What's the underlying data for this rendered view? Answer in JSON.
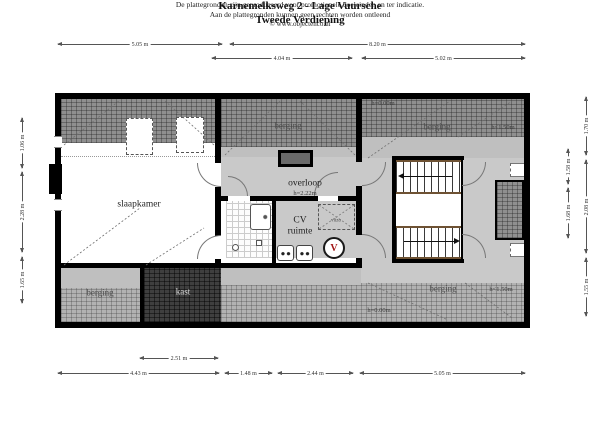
{
  "title": {
    "line1": "Karnemelksweg 2 - Lage Vuursche",
    "line2": "Tweede Verdieping"
  },
  "dims": {
    "t1a": "5.05 m",
    "t1b": "8.20 m",
    "t2a": "4.04 m",
    "t2b": "5.02 m",
    "b1a": "2.51 m",
    "b2a": "4.43 m",
    "b2b": "1.48 m",
    "b2c": "2.44 m",
    "b2d": "5.05 m",
    "l1": "1.06 m",
    "l2": "2.28 m",
    "l3": "1.65 m",
    "r1": "1.70 m",
    "r2": "2.08 m",
    "r3": "1.55 m",
    "ri1": "1.58 m",
    "ri2": "1.68 m"
  },
  "rooms": {
    "slaapkamer": "slaapkamer",
    "overloop": "overloop",
    "overloop_h": "h=2.22m",
    "cv1": "CV",
    "cv2": "ruimte",
    "vlizo": "vlizo",
    "v_unit": "V",
    "kast": "kast",
    "berging_top_mid": "berging",
    "berging_top_right": "berging",
    "berging_bottom_left": "berging",
    "berging_bottom_right": "berging"
  },
  "annotations": {
    "h0_top": "h=0.00m",
    "h150_top": "h<1.50m",
    "h150_bottom": "h<1.50m",
    "h0_bottom": "h=0.00m"
  },
  "footer": {
    "line1": "De plattegronden zijn geproduceerd voor promotionele doeleinden en ter indicatie.",
    "line2": "Aan de plattegronden kunnen geen rechten worden ontleend",
    "line3": "© www.objectenco.nl"
  }
}
